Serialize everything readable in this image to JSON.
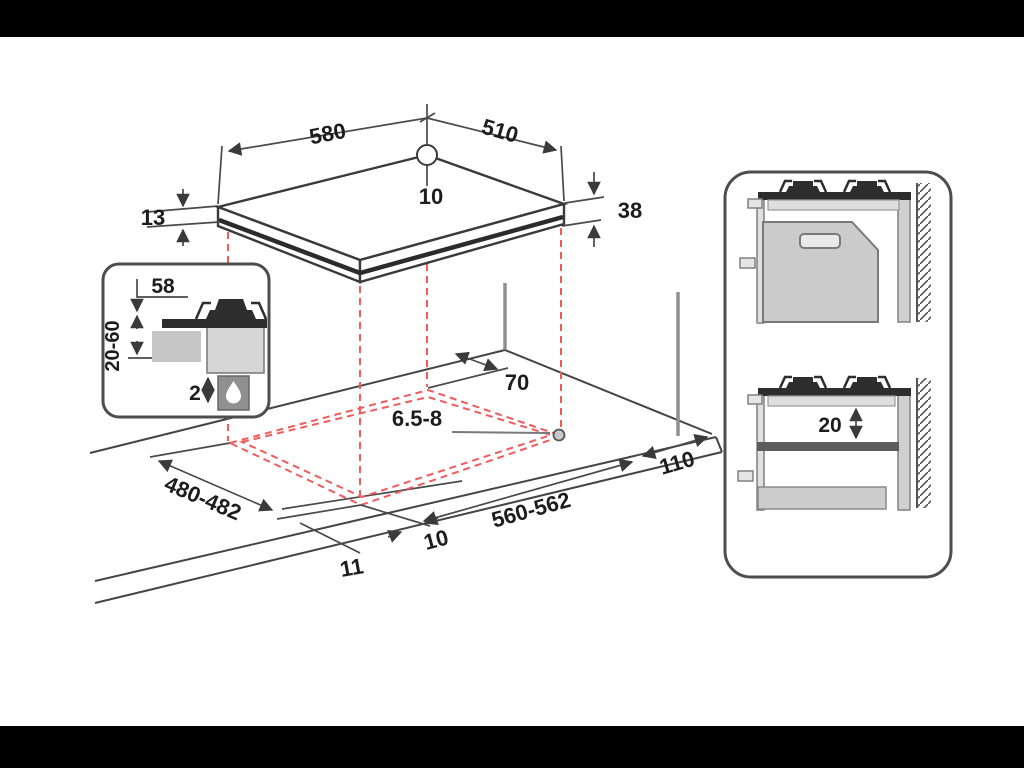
{
  "frame": {
    "letterbox_color": "#000000",
    "canvas_color": "#ffffff"
  },
  "diagram_type": "hob-installation-dimension-drawing",
  "dims": {
    "hob_width": "580",
    "hob_depth": "510",
    "hob_rear_offset": "10",
    "hob_rim": "13",
    "hob_height": "38",
    "inset_top": "58",
    "inset_worktop": "20-60",
    "inset_gap": "2",
    "cutout_hole": "6.5-8",
    "cutout_rear": "70",
    "cutout_depth": "480-482",
    "cutout_width": "560-562",
    "cutout_side": "110",
    "cutout_front": "10",
    "cutout_edge": "11",
    "section_shelf": "20"
  },
  "icons": {
    "inset_flame": "gas-flame-icon"
  },
  "colors": {
    "line": "#454545",
    "dashed_projection": "#f15b5b",
    "fill_dark": "#2d2d2d",
    "fill_light": "#cbcbcb",
    "text": "#1d1d1d"
  }
}
